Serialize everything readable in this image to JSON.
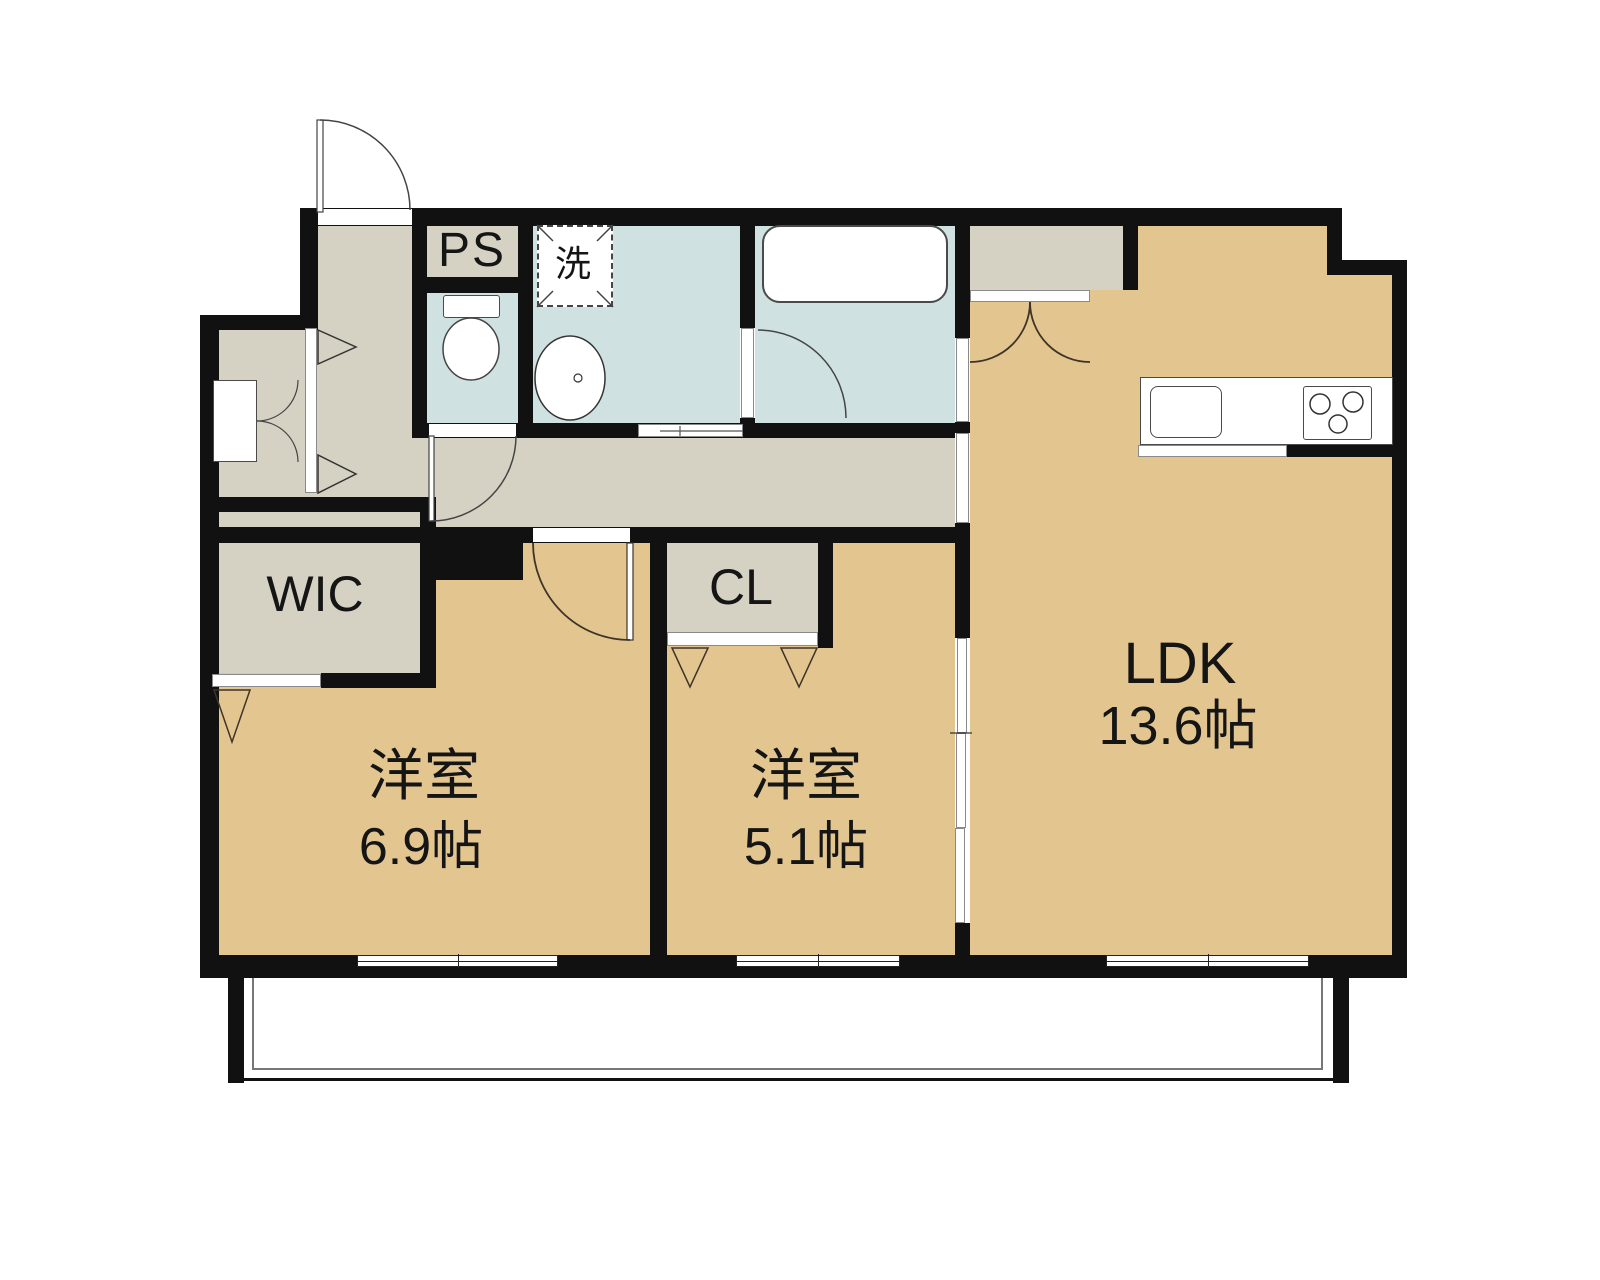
{
  "plan": {
    "type": "floor-plan",
    "rooms": {
      "ps": {
        "label": "PS"
      },
      "laundry": {
        "label": "洗"
      },
      "wic": {
        "label": "WIC"
      },
      "cl": {
        "label": "CL"
      },
      "room1": {
        "name": "洋室",
        "size": "6.9帖"
      },
      "room2": {
        "name": "洋室",
        "size": "5.1帖"
      },
      "ldk": {
        "name": "LDK",
        "size": "13.6帖"
      }
    },
    "colors": {
      "room_fill": "#e3c590",
      "hall_fill": "#d5d2c4",
      "wet_fill": "#cfe2e1",
      "wall": "#111111",
      "door_line": "#3f3428"
    }
  }
}
